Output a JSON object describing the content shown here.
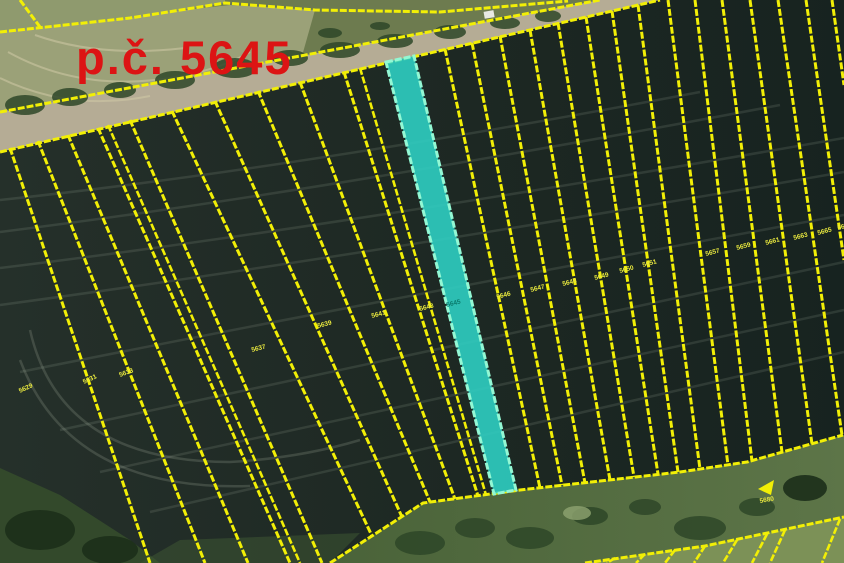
{
  "map": {
    "title": "p.č. 5645",
    "highlighted_parcel": {
      "label": "5645"
    },
    "colors": {
      "title": "#dc1414",
      "parcel_line": "#f2ef06",
      "highlight_fill": "#2fd3c6",
      "highlight_stroke": "#93f8d4",
      "label": "#e9e93f",
      "label_hl": "#0a7c6e",
      "field_dark": "#202b26",
      "road": "#b5ac95",
      "verge_light": "#9ba178",
      "verge_green": "#6d7b4f",
      "corner_field": "#8f9a6e",
      "bottom_green": "#557044",
      "corner_grass": "#7c9157"
    },
    "parcel_labels": [
      {
        "x": 20,
        "y": 393,
        "rot": -25,
        "text": "5629"
      },
      {
        "x": 84,
        "y": 384,
        "rot": -25,
        "text": "5631"
      },
      {
        "x": 120,
        "y": 377,
        "rot": -20,
        "text": "5633"
      },
      {
        "x": 252,
        "y": 352,
        "rot": -15,
        "text": "5637"
      },
      {
        "x": 318,
        "y": 328,
        "rot": -15,
        "text": "5639"
      },
      {
        "x": 372,
        "y": 318,
        "rot": -15,
        "text": "5641"
      },
      {
        "x": 420,
        "y": 311,
        "rot": -15,
        "text": "5643"
      },
      {
        "x": 447,
        "y": 307,
        "rot": -15,
        "text": "5645",
        "hl": true
      },
      {
        "x": 497,
        "y": 299,
        "rot": -15,
        "text": "5646"
      },
      {
        "x": 531,
        "y": 292,
        "rot": -15,
        "text": "5647"
      },
      {
        "x": 563,
        "y": 286,
        "rot": -15,
        "text": "5648"
      },
      {
        "x": 595,
        "y": 280,
        "rot": -15,
        "text": "5649"
      },
      {
        "x": 620,
        "y": 273,
        "rot": -15,
        "text": "5650"
      },
      {
        "x": 643,
        "y": 267,
        "rot": -15,
        "text": "5651"
      },
      {
        "x": 706,
        "y": 256,
        "rot": -15,
        "text": "5657"
      },
      {
        "x": 737,
        "y": 250,
        "rot": -15,
        "text": "5659"
      },
      {
        "x": 766,
        "y": 245,
        "rot": -15,
        "text": "5661"
      },
      {
        "x": 794,
        "y": 240,
        "rot": -15,
        "text": "5663"
      },
      {
        "x": 818,
        "y": 235,
        "rot": -15,
        "text": "5665"
      },
      {
        "x": 838,
        "y": 230,
        "rot": -15,
        "text": "5667"
      },
      {
        "x": 760,
        "y": 503,
        "rot": -10,
        "text": "5680"
      }
    ]
  }
}
